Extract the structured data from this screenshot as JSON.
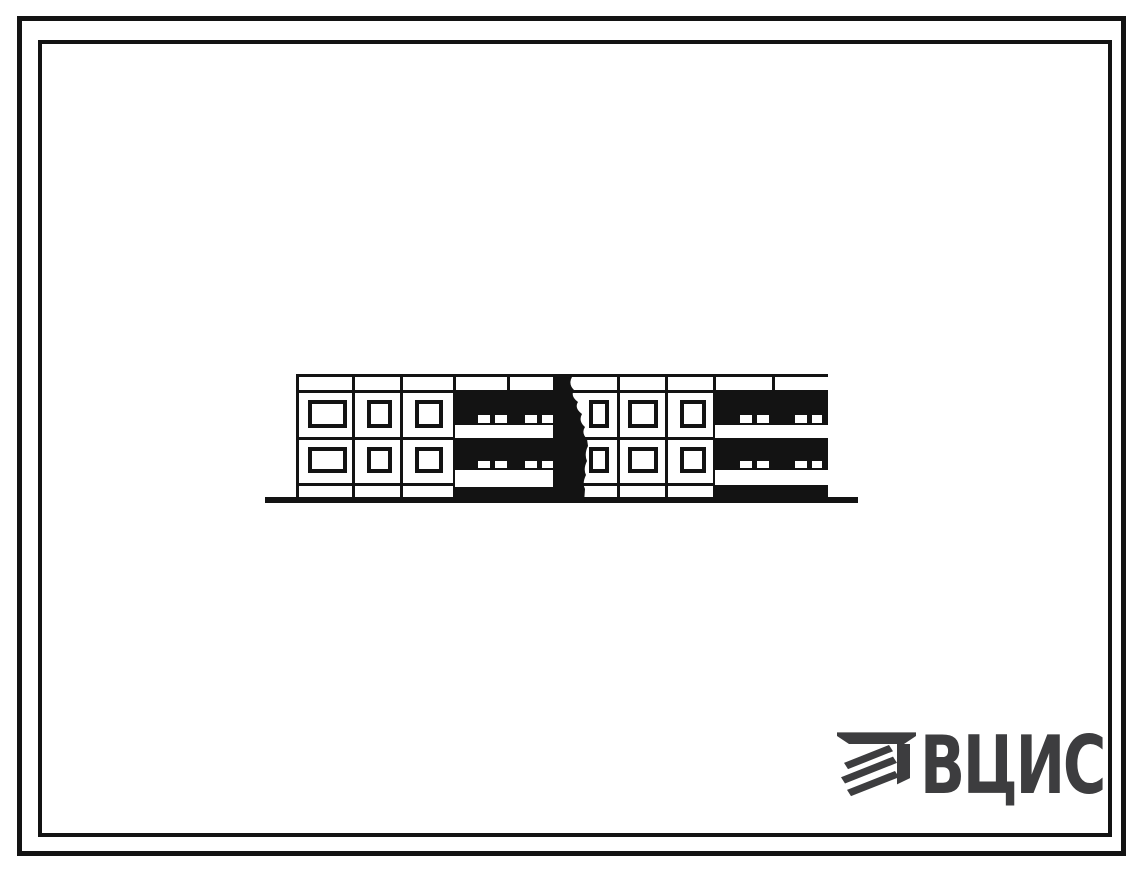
{
  "page": {
    "background_color": "#ffffff",
    "ink_color": "#131313"
  },
  "frame": {
    "outer_border_px": 5,
    "inner_border_px": 4
  },
  "elevation": {
    "kind": "two-storey panel building facade, scanned line drawing",
    "floors": 2,
    "window_bays": 6,
    "windows_total": 12,
    "loggia_sections": 2,
    "loggia_balcony_bands_per_section": 2,
    "has_ground_line": true
  },
  "logo": {
    "wordmark": "ВЦИС",
    "color": "#3d3d3f",
    "emblem_icon": "vcis-emblem"
  }
}
